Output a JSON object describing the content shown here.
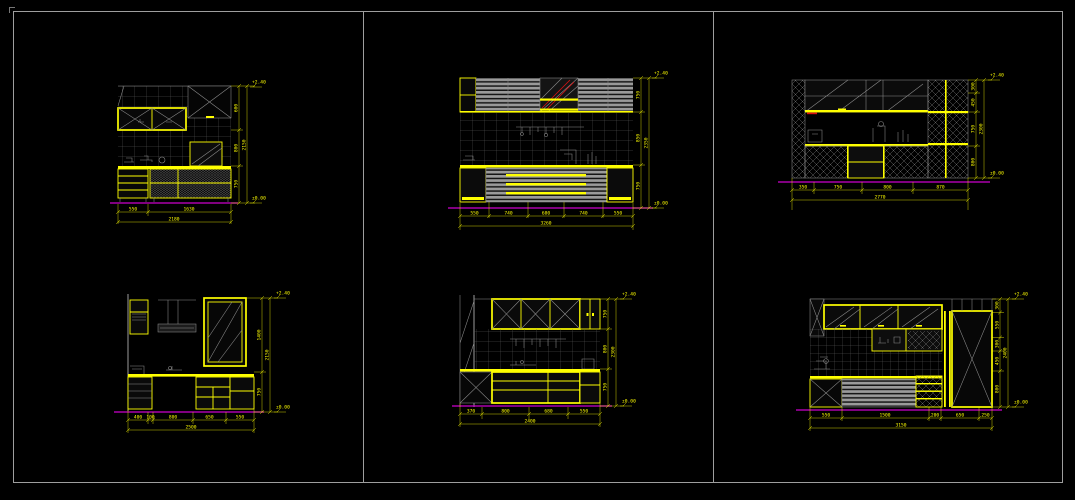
{
  "window": {
    "background": "#000000",
    "frame_color": "#9e9e9e"
  },
  "palette": {
    "cabinet_yellow": "#ffff00",
    "tile_gray": "#8c8c8c",
    "floor_magenta": "#cc00cc",
    "accent_red": "#dd1111"
  },
  "drawings": [
    {
      "name": "kitchen-elevation-top-left",
      "bottom_dims": [
        "550",
        "1630"
      ],
      "bottom_total": "2180",
      "right_dims": [
        "600",
        "800",
        "750"
      ],
      "right_total": "2150",
      "level_top": "+2.40",
      "level_bottom": "±0.00"
    },
    {
      "name": "kitchen-elevation-top-middle",
      "bottom_dims": [
        "550",
        "740",
        "680",
        "740",
        "550"
      ],
      "bottom_total": "3260",
      "right_dims": [
        "750",
        "850",
        "750"
      ],
      "right_total": "2350",
      "level_top": "+2.40",
      "level_bottom": "±0.00"
    },
    {
      "name": "kitchen-elevation-top-right",
      "bottom_dims": [
        "350",
        "750",
        "800",
        "870"
      ],
      "bottom_total": "2770",
      "right_dims": [
        "300",
        "450",
        "750",
        "800"
      ],
      "right_total": "2300",
      "level_top": "+2.40",
      "level_bottom": "±0.00"
    },
    {
      "name": "kitchen-elevation-bottom-left",
      "bottom_dims": [
        "400",
        "100",
        "800",
        "650",
        "550"
      ],
      "bottom_total": "2500",
      "right_dims": [
        "1400",
        "750"
      ],
      "right_total": "2150",
      "level_top": "+2.40",
      "level_bottom": "±0.00"
    },
    {
      "name": "kitchen-elevation-bottom-middle",
      "bottom_dims": [
        "370",
        "800",
        "680",
        "550"
      ],
      "bottom_total": "2400",
      "right_dims": [
        "750",
        "800",
        "750"
      ],
      "right_total": "2300",
      "level_top": "+2.40",
      "level_bottom": "±0.00"
    },
    {
      "name": "kitchen-elevation-bottom-right",
      "bottom_dims": [
        "550",
        "1500",
        "200",
        "650",
        "250"
      ],
      "bottom_total": "3150",
      "right_dims": [
        "300",
        "550",
        "300",
        "450",
        "800"
      ],
      "right_total": "2400",
      "level_top": "+2.40",
      "level_bottom": "±0.00"
    }
  ]
}
